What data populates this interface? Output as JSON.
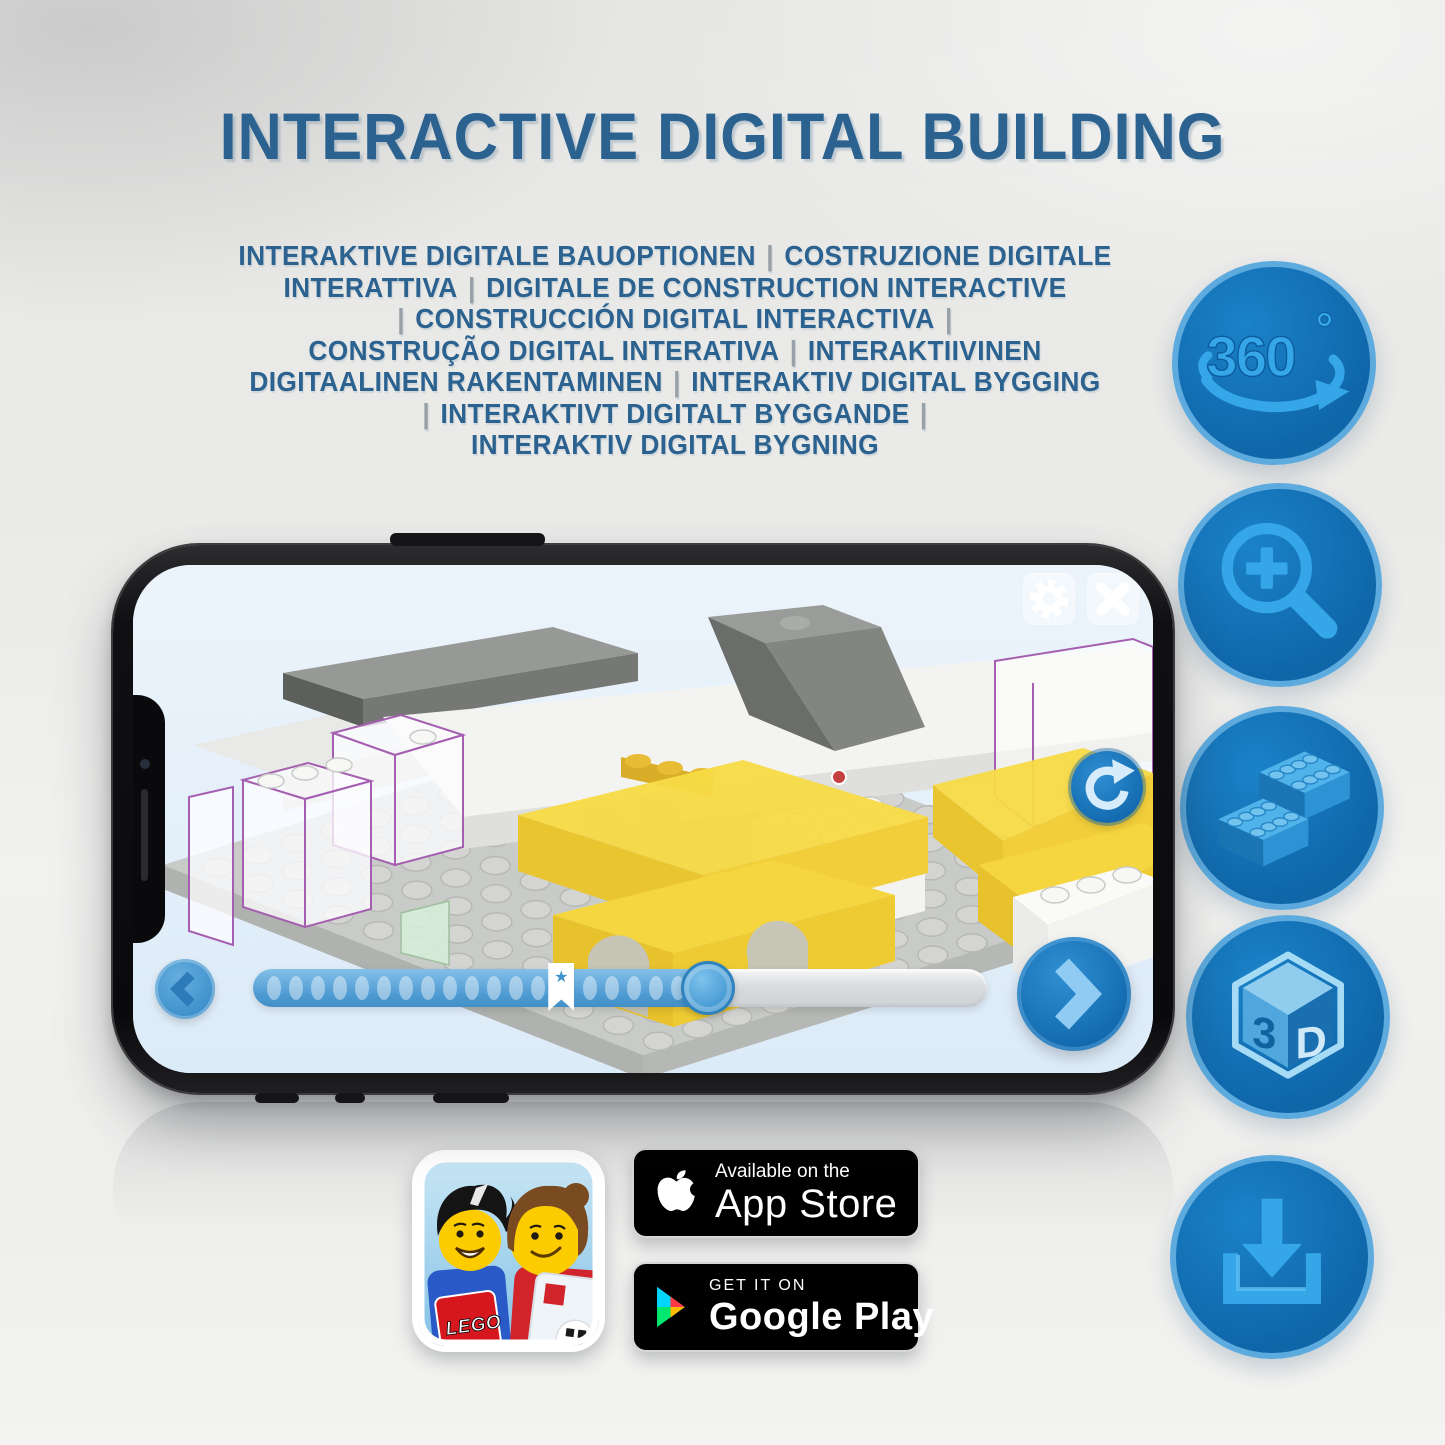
{
  "title": "INTERACTIVE DIGITAL BUILDING",
  "subtitle": {
    "separator": "|",
    "lines": [
      "INTERAKTIVE DIGITALE BAUOPTIONEN | COSTRUZIONE DIGITALE",
      "INTERATTIVA | DIGITALE DE CONSTRUCTION INTERACTIVE",
      "| CONSTRUCCIÓN DIGITAL INTERACTIVA |",
      "CONSTRUÇÃO DIGITAL INTERATIVA | INTERAKTIIVINEN",
      "DIGITAALINEN RAKENTAMINEN | INTERAKTIV DIGITAL BYGGING",
      "| INTERAKTIVT DIGITALT BYGGANDE |",
      "INTERAKTIV DIGITAL BYGNING"
    ]
  },
  "features": {
    "rotation": {
      "icon": "360-rotation-icon",
      "label": "360",
      "degree": "°"
    },
    "zoom": {
      "icon": "zoom-in-icon"
    },
    "bricks": {
      "icon": "lego-bricks-icon"
    },
    "cube": {
      "icon": "3d-cube-icon",
      "label_3": "3",
      "label_d": "D"
    },
    "download": {
      "icon": "download-icon"
    }
  },
  "app_screen": {
    "controls": {
      "settings_icon": "gear-icon",
      "close_icon": "close-icon",
      "rotate_icon": "rotate-icon",
      "previous_icon": "chevron-left-icon",
      "next_icon": "chevron-right-icon",
      "bookmark_star": "★"
    },
    "progress": {
      "dots_before_bookmark": 13,
      "dots_after_bookmark": 5,
      "bookmark_position_percent": 42,
      "handle_position_percent": 62,
      "fill_percent": 62
    }
  },
  "store_badges": {
    "app_store": {
      "icon": "apple-icon",
      "line1": "Available on the",
      "line2": "App Store"
    },
    "google_play": {
      "icon": "google-play-icon",
      "line1": "GET IT ON",
      "line2": "Google Play"
    }
  },
  "app_icon": {
    "logo_text": "LEGO"
  },
  "colors": {
    "title_text": "#2b628f",
    "separator": "#98a1a8",
    "feature_circle_fill": "#0f66a9",
    "feature_circle_border": "#5caade",
    "feature_glyph": "#35a7e8",
    "app_accent_blue": "#2f8fd2",
    "lego_yellow": "#f6d842",
    "badge_background": "#000000"
  }
}
